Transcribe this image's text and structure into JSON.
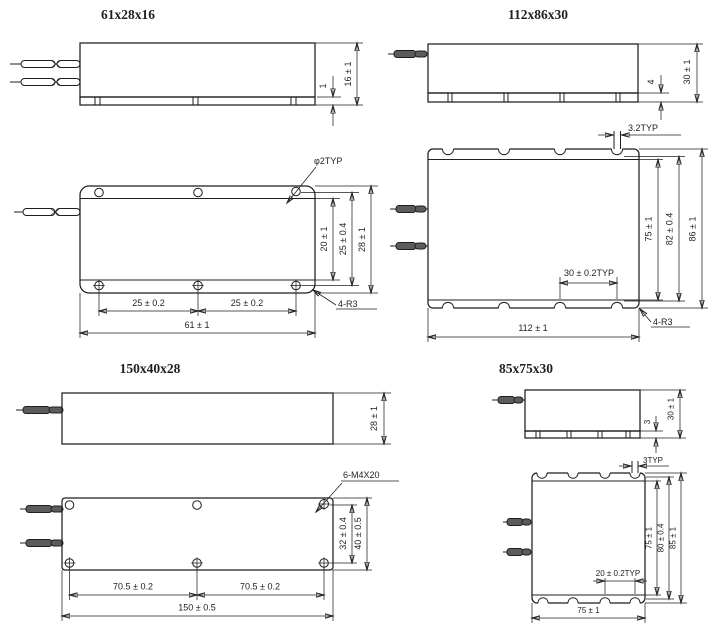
{
  "page": {
    "background": "#ffffff",
    "ink": "#1f1f1f",
    "description": "Outline dimension drawings of four fiber-pigtailed enclosure sizes"
  },
  "drawings": [
    {
      "title": "61x28x16",
      "side": {
        "dim_base": "1",
        "dim_height": "16 ± 1"
      },
      "top": {
        "hole_callout": "φ2TYP",
        "dim_flange": "20 ± 1",
        "dim_hole_rows": "25 ± 0.4",
        "dim_depth": "28 ± 1",
        "dim_pitch_left": "25 ± 0.2",
        "dim_pitch_right": "25 ± 0.2",
        "dim_width": "61 ± 1",
        "corner_callout": "4-R3"
      }
    },
    {
      "title": "112x86x30",
      "side": {
        "dim_base": "4",
        "dim_height": "30 ± 1"
      },
      "top": {
        "slot_callout": "3.2TYP",
        "dim_flange": "75 ± 1",
        "dim_slot_rows": "82 ± 0.4",
        "dim_depth": "86 ± 1",
        "dim_slot_pitch": "30 ± 0.2TYP",
        "dim_width": "112 ± 1",
        "corner_callout": "4-R3"
      }
    },
    {
      "title": "150x40x28",
      "side": {
        "dim_height": "28 ± 1"
      },
      "top": {
        "hole_callout": "6-M4X20",
        "dim_hole_rows": "32 ± 0.4",
        "dim_depth": "40 ± 0.5",
        "dim_pitch_left": "70.5 ± 0.2",
        "dim_pitch_right": "70.5 ± 0.2",
        "dim_width": "150 ± 0.5"
      }
    },
    {
      "title": "85x75x30",
      "side": {
        "dim_base": "3",
        "dim_height": "30 ± 1"
      },
      "top": {
        "slot_callout": "3TYP",
        "dim_flange": "75 ± 1",
        "dim_slot_rows": "80 ± 0.4",
        "dim_depth": "85 ± 1",
        "dim_slot_pitch": "20 ± 0.2TYP",
        "dim_width": "75 ± 1"
      }
    }
  ]
}
